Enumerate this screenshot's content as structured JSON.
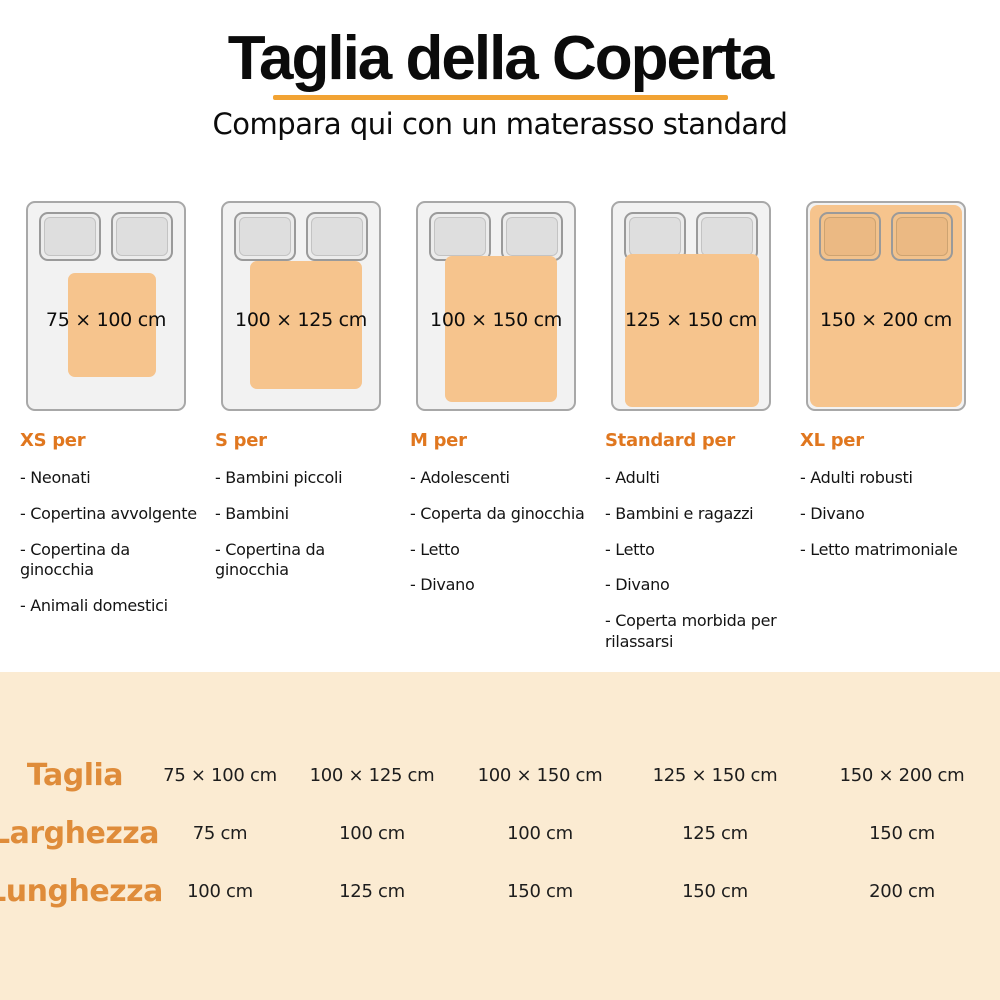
{
  "header": {
    "title": "Taglia della Coperta",
    "subtitle": "Compara qui con un materasso standard"
  },
  "colors": {
    "accent_orange": "#F2A333",
    "heading_orange": "#E0771F",
    "blanket_orange": "#F6C48D",
    "table_label_orange": "#DF8C3A",
    "table_band_bg": "#FBEBD2",
    "bed_fill": "#F2F2F2",
    "bed_border": "#A8A8A8"
  },
  "cards": [
    {
      "size_label": "75 × 100 cm",
      "heading": "XS per",
      "items": [
        "- Neonati",
        "- Copertina avvolgente",
        "- Copertina da ginocchia",
        "- Animali domestici"
      ]
    },
    {
      "size_label": "100 × 125 cm",
      "heading": "S per",
      "items": [
        "- Bambini piccoli",
        "- Bambini",
        "- Copertina da ginocchia"
      ]
    },
    {
      "size_label": "100 × 150 cm",
      "heading": "M per",
      "items": [
        "- Adolescenti",
        "- Coperta da ginocchia",
        "- Letto",
        "- Divano"
      ]
    },
    {
      "size_label": "125 × 150 cm",
      "heading": "Standard per",
      "items": [
        "- Adulti",
        "- Bambini e ragazzi",
        "- Letto",
        "- Divano",
        "- Coperta morbida per rilassarsi"
      ]
    },
    {
      "size_label": "150 × 200 cm",
      "heading": "XL per",
      "items": [
        "- Adulti robusti",
        "- Divano",
        "- Letto matrimoniale"
      ]
    }
  ],
  "table": {
    "rows": [
      {
        "label": "Taglia",
        "values": [
          "75 × 100 cm",
          "100 × 125 cm",
          "100 × 150 cm",
          "125 × 150 cm",
          "150 × 200 cm"
        ]
      },
      {
        "label": "Larghezza",
        "values": [
          "75 cm",
          "100 cm",
          "100 cm",
          "125 cm",
          "150 cm"
        ]
      },
      {
        "label": "Lunghezza",
        "values": [
          "100 cm",
          "125 cm",
          "150 cm",
          "150 cm",
          "200 cm"
        ]
      }
    ]
  }
}
